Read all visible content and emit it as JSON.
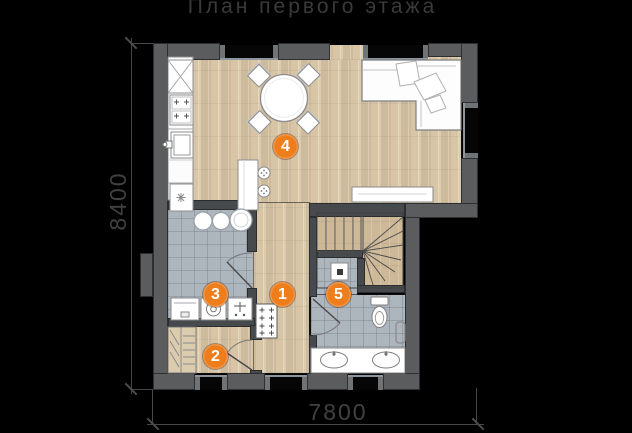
{
  "title": "План первого этажа",
  "dimensions": {
    "vertical": "8400",
    "horizontal": "7800"
  },
  "markers": [
    {
      "label": "1"
    },
    {
      "label": "2"
    },
    {
      "label": "3"
    },
    {
      "label": "4"
    },
    {
      "label": "5"
    }
  ],
  "colors": {
    "background": "#000000",
    "marker_accent": "#ee7d1b",
    "wall": "#5a5c5e",
    "wood_floor": "#d8c5a6",
    "tile_floor": "#adb5bd",
    "title_text": "#3a3a3a",
    "dimension_text": "#414141"
  }
}
